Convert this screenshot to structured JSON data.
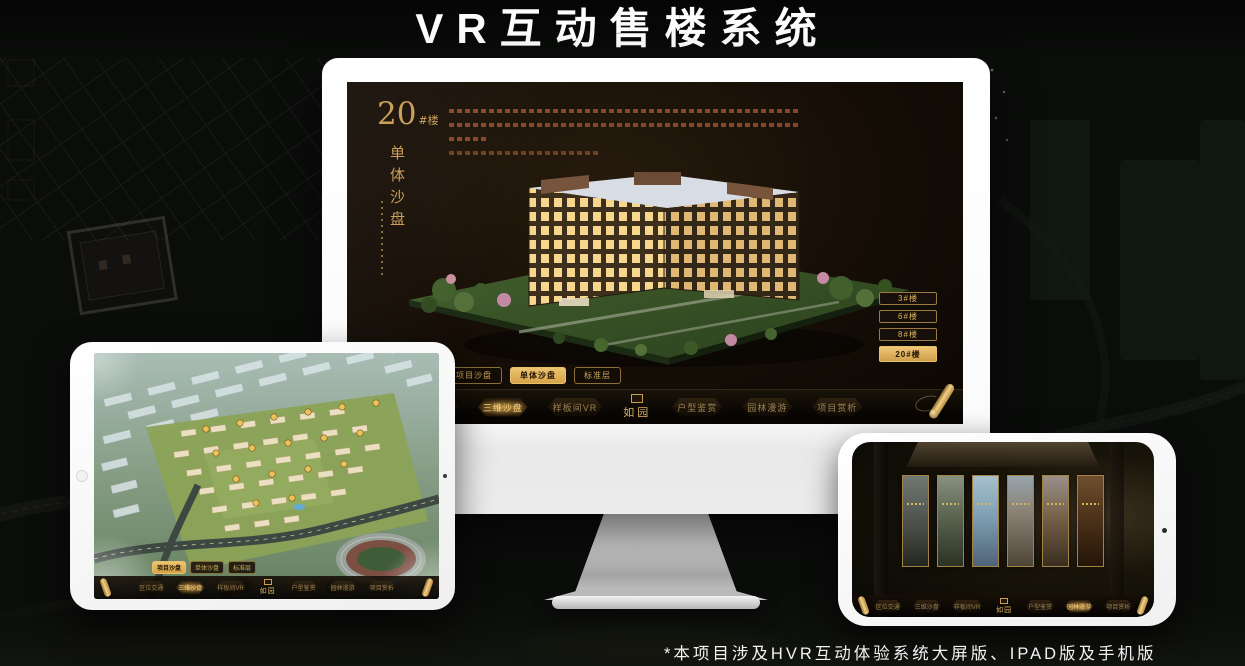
{
  "page": {
    "title": "VR互动售楼系统",
    "footnote": "*本项目涉及HVR互动体验系统大屏版、IPAD版及手机版"
  },
  "colors": {
    "gold": "#D9AD55",
    "gold_bright": "#F0C86E",
    "screen_bg": "#15100A",
    "nav_inactive_text": "#9B8152"
  },
  "monitor": {
    "heading": {
      "number": "20",
      "suffix": "#楼",
      "subtitle": "单体沙盘"
    },
    "floor_buttons": [
      {
        "label": "3#楼"
      },
      {
        "label": "6#楼"
      },
      {
        "label": "8#楼"
      },
      {
        "label": "20#楼",
        "active": true
      }
    ],
    "sub_tabs": [
      {
        "label": "项目沙盘"
      },
      {
        "label": "单体沙盘",
        "active": true
      },
      {
        "label": "标准层"
      }
    ],
    "nav_items": [
      {
        "label": "区位交通"
      },
      {
        "label": "三维沙盘",
        "active": true
      },
      {
        "label": "样板间VR"
      },
      {
        "label": "如园",
        "type": "logo"
      },
      {
        "label": "户型鉴赏"
      },
      {
        "label": "园林漫游"
      },
      {
        "label": "项目赏析"
      }
    ]
  },
  "ipad": {
    "sub_tabs": [
      {
        "label": "项目沙盘",
        "active": true
      },
      {
        "label": "单体沙盘"
      },
      {
        "label": "标准层"
      }
    ],
    "nav_items": [
      {
        "label": "区位交通"
      },
      {
        "label": "三维沙盘",
        "active": true
      },
      {
        "label": "样板间VR"
      },
      {
        "label": "如园",
        "type": "logo"
      },
      {
        "label": "户型鉴赏"
      },
      {
        "label": "园林漫游"
      },
      {
        "label": "项目赏析"
      }
    ]
  },
  "phone": {
    "gallery": [
      {
        "tone": "t1"
      },
      {
        "tone": "t2"
      },
      {
        "tone": "t3"
      },
      {
        "tone": "t4"
      },
      {
        "tone": "t5"
      },
      {
        "tone": "t6"
      }
    ],
    "nav_items": [
      {
        "label": "区位交通"
      },
      {
        "label": "三维沙盘"
      },
      {
        "label": "样板间VR"
      },
      {
        "label": "如园",
        "type": "logo"
      },
      {
        "label": "户型鉴赏"
      },
      {
        "label": "园林漫游",
        "active": true
      },
      {
        "label": "项目赏析"
      }
    ]
  }
}
